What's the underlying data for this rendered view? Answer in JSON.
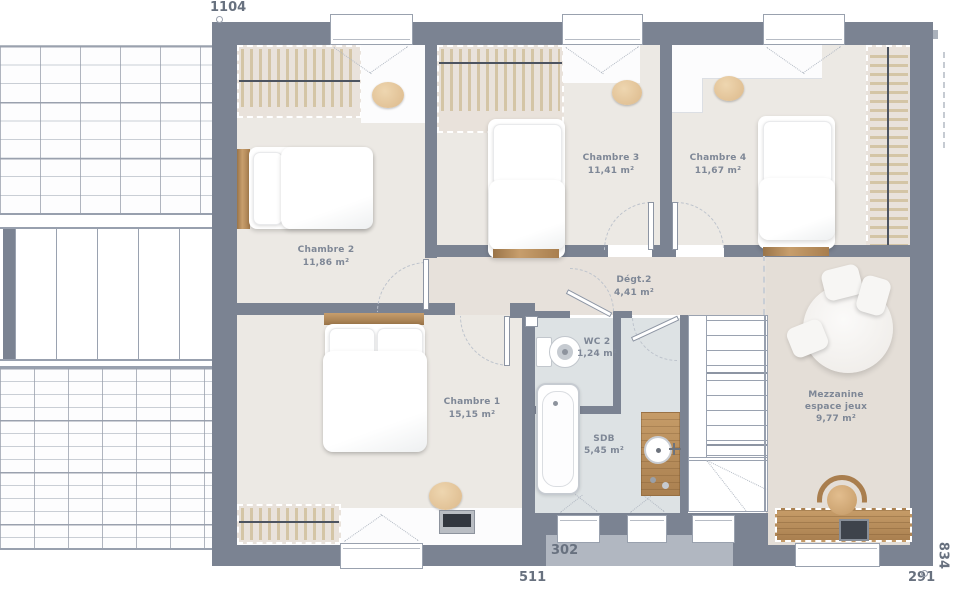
{
  "dimensions": {
    "top": "1104",
    "bottom_left": "511",
    "bottom_middle": "302",
    "bottom_right": "291",
    "right": "834"
  },
  "rooms": [
    {
      "name": "Chambre 2",
      "area": "11,86 m²"
    },
    {
      "name": "Chambre 3",
      "area": "11,41 m²"
    },
    {
      "name": "Chambre 4",
      "area": "11,67 m²"
    },
    {
      "name": "Chambre 1",
      "area": "15,15 m²"
    },
    {
      "name": "Dégt.2",
      "area": "4,41 m²"
    },
    {
      "name": "WC 2",
      "area": "1,24 m²"
    },
    {
      "name": "SDB",
      "area": "5,45 m²"
    },
    {
      "name": "Mezzanine",
      "name_line2": "espace jeux",
      "area": "9,77 m²"
    }
  ],
  "colors": {
    "wall": "#7b8392",
    "room_floor": "#ece9e4",
    "hall_floor": "#e7e1db",
    "bath_floor": "#dde2e4",
    "mezzanine_floor": "#e4ded7",
    "closet_fill": "#e9e2db",
    "wood": "#b98f5e",
    "label_text": "#7e8796"
  }
}
